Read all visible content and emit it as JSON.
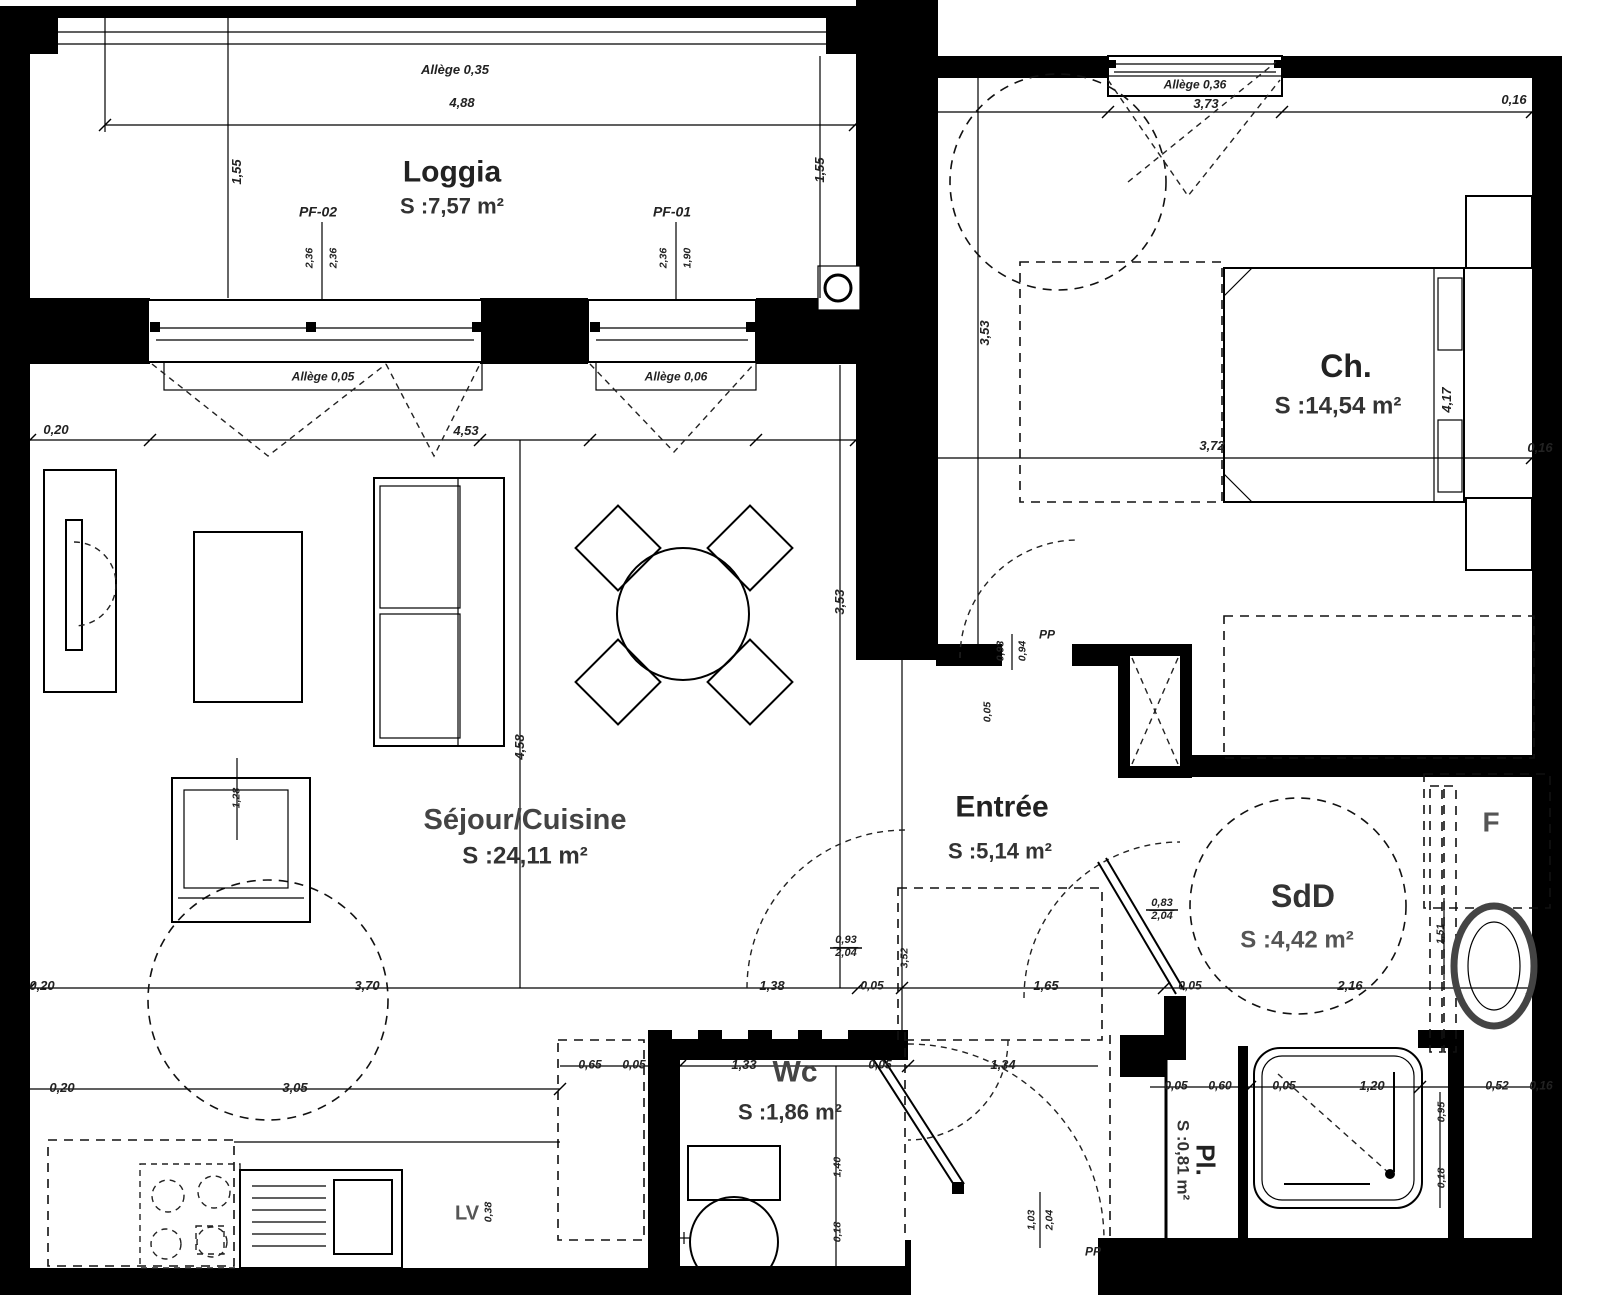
{
  "rooms": {
    "loggia": {
      "name": "Loggia",
      "area": "S :7,57 m²"
    },
    "chambre": {
      "name": "Ch.",
      "area": "S :14,54 m²"
    },
    "sejour": {
      "name": "Séjour/Cuisine",
      "area": "S :24,11 m²"
    },
    "entree": {
      "name": "Entrée",
      "area": "S :5,14 m²"
    },
    "sdd": {
      "name": "SdD",
      "area": "S :4,42 m²"
    },
    "wc": {
      "name": "Wc",
      "area": "S :1,86 m²"
    },
    "placard": {
      "name": "Pl.",
      "area": "S :0,81 m²"
    }
  },
  "windows": {
    "pf02": "PF-02",
    "pf01": "PF-01",
    "allege_035": "Allège 0,35",
    "allege_036": "Allège 0,36",
    "allege_005": "Allège 0,05",
    "allege_006": "Allège 0,06"
  },
  "doors": {
    "pp_bedroom": "PP",
    "pp_entrance": "PP"
  },
  "appliances": {
    "lv": "LV",
    "f": "F"
  },
  "dims": {
    "t020": "0,20",
    "h488": "4,88",
    "v155l": "1,55",
    "v155r": "1,55",
    "h453": "4,53",
    "h373": "3,73",
    "r016a": "0,16",
    "r016b": "0,16",
    "h372": "3,72",
    "v417": "4,17",
    "v353a": "3,53",
    "v353b": "3,53",
    "v458": "4,58",
    "v128": "1,28",
    "h138": "1,38",
    "h005a": "0,05",
    "v352": "3,52",
    "h165": "1,65",
    "h005b": "0,05",
    "h216": "2,16",
    "f093": "0,93",
    "f204": "2,04",
    "f083": "0,83",
    "f204b": "2,04",
    "v151": "1,51",
    "h020b": "0,20",
    "h370": "3,70",
    "h020c": "0,20",
    "h305": "3,05",
    "h065": "0,65",
    "h005c": "0,05",
    "h133": "1,33",
    "h005d": "0,05",
    "h134": "1,34",
    "v140": "1,40",
    "v018a": "0,18",
    "h005e": "0,05",
    "h060": "0,60",
    "h005f": "0,05",
    "h120": "1,20",
    "h052": "0,52",
    "h016c": "0,16",
    "v095": "0,95",
    "v018b": "0,18",
    "v103": "1,03",
    "v204": "2,04",
    "pf02a": "2,36",
    "pf02b": "2,36",
    "pf01a": "2,36",
    "pf01b": "1,90",
    "e093": "0,93",
    "e094": "0,94",
    "e005": "0,05",
    "v038": "0,38"
  }
}
